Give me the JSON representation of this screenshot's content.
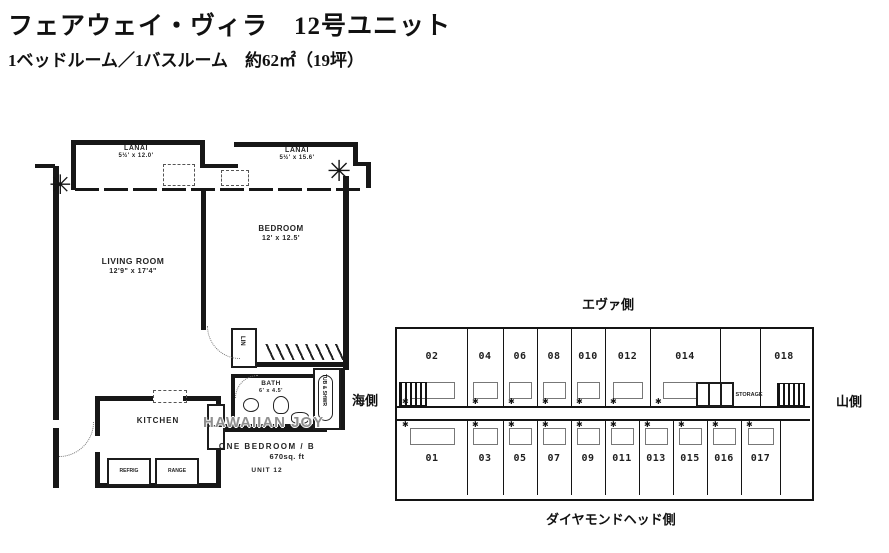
{
  "header": {
    "title": "フェアウェイ・ヴィラ　12号ユニット",
    "subtitle": "1ベッドルーム／1バスルーム　約62㎡（19坪）"
  },
  "unit_plan": {
    "lanai1": {
      "name": "LANAI",
      "dim": "5½' x 12.0'"
    },
    "lanai2": {
      "name": "LANAI",
      "dim": "5½' x 15.6'"
    },
    "living": {
      "name": "LIVING ROOM",
      "dim": "12'9\" x 17'4\""
    },
    "bedroom": {
      "name": "BEDROOM",
      "dim": "12' x 12.5'"
    },
    "kitchen": {
      "name": "KITCHEN"
    },
    "bath": {
      "name": "BATH",
      "dim": "6' x 4.5'"
    },
    "tub_label": "TUB & SHWR",
    "lin_label": "LIN",
    "refrig_label": "REFRIG",
    "range_label": "RANGE",
    "watermark": "HAWAIIAN JOY",
    "summary": {
      "line1": "ONE BEDROOM / B",
      "line2": "670sq. ft",
      "line3": "UNIT 12"
    }
  },
  "floor_map": {
    "labels": {
      "top": "エヴァ側",
      "bottom": "ダイヤモンドヘッド側",
      "left": "海側",
      "right": "山側"
    },
    "storage_label": "STORAGE",
    "top_units": [
      "02",
      "04",
      "06",
      "08",
      "010",
      "012",
      "014",
      "018"
    ],
    "bottom_units": [
      "01",
      "03",
      "05",
      "07",
      "09",
      "011",
      "013",
      "015",
      "016",
      "017"
    ]
  }
}
